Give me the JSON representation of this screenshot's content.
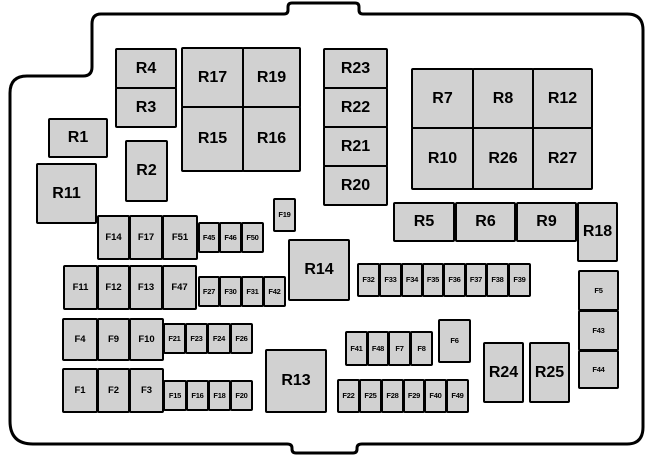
{
  "colors": {
    "background": "#ffffff",
    "box_fill": "#d1d1d1",
    "box_border": "#000000",
    "outline": "#000000"
  },
  "boxes": [
    {
      "label": "R4",
      "kind": "lg",
      "x": 115,
      "y": 48,
      "w": 62,
      "h": 41
    },
    {
      "label": "R3",
      "kind": "lg",
      "x": 115,
      "y": 87,
      "w": 62,
      "h": 41
    },
    {
      "label": "R17",
      "kind": "lg",
      "x": 181,
      "y": 47,
      "w": 63,
      "h": 61
    },
    {
      "label": "R19",
      "kind": "lg",
      "x": 242,
      "y": 47,
      "w": 59,
      "h": 61
    },
    {
      "label": "R15",
      "kind": "lg",
      "x": 181,
      "y": 106,
      "w": 63,
      "h": 66
    },
    {
      "label": "R16",
      "kind": "lg",
      "x": 242,
      "y": 106,
      "w": 59,
      "h": 66
    },
    {
      "label": "R1",
      "kind": "lg",
      "x": 48,
      "y": 118,
      "w": 60,
      "h": 40
    },
    {
      "label": "R2",
      "kind": "lg",
      "x": 125,
      "y": 140,
      "w": 43,
      "h": 62
    },
    {
      "label": "R11",
      "kind": "lg",
      "x": 36,
      "y": 163,
      "w": 61,
      "h": 61
    },
    {
      "label": "R23",
      "kind": "lg",
      "x": 323,
      "y": 48,
      "w": 65,
      "h": 41
    },
    {
      "label": "R22",
      "kind": "lg",
      "x": 323,
      "y": 87,
      "w": 65,
      "h": 41
    },
    {
      "label": "R21",
      "kind": "lg",
      "x": 323,
      "y": 126,
      "w": 65,
      "h": 41
    },
    {
      "label": "R20",
      "kind": "lg",
      "x": 323,
      "y": 165,
      "w": 65,
      "h": 41
    },
    {
      "label": "R7",
      "kind": "lg",
      "x": 411,
      "y": 68,
      "w": 63,
      "h": 61
    },
    {
      "label": "R8",
      "kind": "lg",
      "x": 472,
      "y": 68,
      "w": 62,
      "h": 61
    },
    {
      "label": "R12",
      "kind": "lg",
      "x": 532,
      "y": 68,
      "w": 61,
      "h": 61
    },
    {
      "label": "R10",
      "kind": "lg",
      "x": 411,
      "y": 127,
      "w": 63,
      "h": 63
    },
    {
      "label": "R26",
      "kind": "lg",
      "x": 472,
      "y": 127,
      "w": 62,
      "h": 63
    },
    {
      "label": "R27",
      "kind": "lg",
      "x": 532,
      "y": 127,
      "w": 61,
      "h": 63
    },
    {
      "label": "R5",
      "kind": "lg",
      "x": 393,
      "y": 202,
      "w": 62,
      "h": 40
    },
    {
      "label": "R6",
      "kind": "lg",
      "x": 455,
      "y": 202,
      "w": 61,
      "h": 40
    },
    {
      "label": "R9",
      "kind": "lg",
      "x": 516,
      "y": 202,
      "w": 61,
      "h": 40
    },
    {
      "label": "R18",
      "kind": "lg",
      "x": 577,
      "y": 202,
      "w": 41,
      "h": 60
    },
    {
      "label": "R14",
      "kind": "lg",
      "x": 288,
      "y": 239,
      "w": 62,
      "h": 62
    },
    {
      "label": "R13",
      "kind": "lg",
      "x": 265,
      "y": 349,
      "w": 62,
      "h": 64
    },
    {
      "label": "R24",
      "kind": "lg",
      "x": 483,
      "y": 342,
      "w": 41,
      "h": 61
    },
    {
      "label": "R25",
      "kind": "lg",
      "x": 529,
      "y": 342,
      "w": 41,
      "h": 61
    },
    {
      "label": "F14",
      "kind": "md",
      "x": 97,
      "y": 215,
      "w": 33,
      "h": 45
    },
    {
      "label": "F17",
      "kind": "md",
      "x": 129,
      "y": 215,
      "w": 34,
      "h": 45
    },
    {
      "label": "F51",
      "kind": "md",
      "x": 162,
      "y": 215,
      "w": 36,
      "h": 45
    },
    {
      "label": "F11",
      "kind": "md",
      "x": 63,
      "y": 265,
      "w": 35,
      "h": 45
    },
    {
      "label": "F12",
      "kind": "md",
      "x": 97,
      "y": 265,
      "w": 33,
      "h": 45
    },
    {
      "label": "F13",
      "kind": "md",
      "x": 129,
      "y": 265,
      "w": 34,
      "h": 45
    },
    {
      "label": "F47",
      "kind": "md",
      "x": 162,
      "y": 265,
      "w": 35,
      "h": 45
    },
    {
      "label": "F4",
      "kind": "md",
      "x": 62,
      "y": 318,
      "w": 36,
      "h": 43
    },
    {
      "label": "F9",
      "kind": "md",
      "x": 97,
      "y": 318,
      "w": 33,
      "h": 43
    },
    {
      "label": "F10",
      "kind": "md",
      "x": 129,
      "y": 318,
      "w": 35,
      "h": 43
    },
    {
      "label": "F1",
      "kind": "md",
      "x": 62,
      "y": 368,
      "w": 36,
      "h": 45
    },
    {
      "label": "F2",
      "kind": "md",
      "x": 97,
      "y": 368,
      "w": 33,
      "h": 45
    },
    {
      "label": "F3",
      "kind": "md",
      "x": 129,
      "y": 368,
      "w": 35,
      "h": 45
    },
    {
      "label": "F45",
      "kind": "sm",
      "x": 198,
      "y": 222,
      "w": 22,
      "h": 31
    },
    {
      "label": "F46",
      "kind": "sm",
      "x": 219,
      "y": 222,
      "w": 23,
      "h": 31
    },
    {
      "label": "F50",
      "kind": "sm",
      "x": 241,
      "y": 222,
      "w": 23,
      "h": 31
    },
    {
      "label": "F27",
      "kind": "sm",
      "x": 198,
      "y": 276,
      "w": 22,
      "h": 31
    },
    {
      "label": "F30",
      "kind": "sm",
      "x": 219,
      "y": 276,
      "w": 23,
      "h": 31
    },
    {
      "label": "F31",
      "kind": "sm",
      "x": 241,
      "y": 276,
      "w": 23,
      "h": 31
    },
    {
      "label": "F42",
      "kind": "sm",
      "x": 263,
      "y": 276,
      "w": 23,
      "h": 31
    },
    {
      "label": "F21",
      "kind": "sm",
      "x": 163,
      "y": 323,
      "w": 23,
      "h": 31
    },
    {
      "label": "F23",
      "kind": "sm",
      "x": 185,
      "y": 323,
      "w": 23,
      "h": 31
    },
    {
      "label": "F24",
      "kind": "sm",
      "x": 207,
      "y": 323,
      "w": 24,
      "h": 31
    },
    {
      "label": "F26",
      "kind": "sm",
      "x": 230,
      "y": 323,
      "w": 23,
      "h": 31
    },
    {
      "label": "F15",
      "kind": "sm",
      "x": 163,
      "y": 380,
      "w": 24,
      "h": 31
    },
    {
      "label": "F16",
      "kind": "sm",
      "x": 186,
      "y": 380,
      "w": 23,
      "h": 31
    },
    {
      "label": "F18",
      "kind": "sm",
      "x": 208,
      "y": 380,
      "w": 23,
      "h": 31
    },
    {
      "label": "F20",
      "kind": "sm",
      "x": 230,
      "y": 380,
      "w": 23,
      "h": 31
    },
    {
      "label": "F19",
      "kind": "sm",
      "x": 273,
      "y": 198,
      "w": 23,
      "h": 34
    },
    {
      "label": "F32",
      "kind": "sm",
      "x": 357,
      "y": 263,
      "w": 23,
      "h": 34
    },
    {
      "label": "F33",
      "kind": "sm",
      "x": 379,
      "y": 263,
      "w": 23,
      "h": 34
    },
    {
      "label": "F34",
      "kind": "sm",
      "x": 401,
      "y": 263,
      "w": 22,
      "h": 34
    },
    {
      "label": "F35",
      "kind": "sm",
      "x": 422,
      "y": 263,
      "w": 22,
      "h": 34
    },
    {
      "label": "F36",
      "kind": "sm",
      "x": 443,
      "y": 263,
      "w": 23,
      "h": 34
    },
    {
      "label": "F37",
      "kind": "sm",
      "x": 465,
      "y": 263,
      "w": 22,
      "h": 34
    },
    {
      "label": "F38",
      "kind": "sm",
      "x": 486,
      "y": 263,
      "w": 23,
      "h": 34
    },
    {
      "label": "F39",
      "kind": "sm",
      "x": 508,
      "y": 263,
      "w": 23,
      "h": 34
    },
    {
      "label": "F41",
      "kind": "sm",
      "x": 345,
      "y": 331,
      "w": 23,
      "h": 35
    },
    {
      "label": "F48",
      "kind": "sm",
      "x": 367,
      "y": 331,
      "w": 22,
      "h": 35
    },
    {
      "label": "F7",
      "kind": "sm",
      "x": 388,
      "y": 331,
      "w": 23,
      "h": 35
    },
    {
      "label": "F8",
      "kind": "sm",
      "x": 410,
      "y": 331,
      "w": 23,
      "h": 35
    },
    {
      "label": "F6",
      "kind": "sm",
      "x": 438,
      "y": 319,
      "w": 33,
      "h": 44
    },
    {
      "label": "F22",
      "kind": "sm",
      "x": 337,
      "y": 379,
      "w": 23,
      "h": 34
    },
    {
      "label": "F25",
      "kind": "sm",
      "x": 359,
      "y": 379,
      "w": 23,
      "h": 34
    },
    {
      "label": "F28",
      "kind": "sm",
      "x": 381,
      "y": 379,
      "w": 23,
      "h": 34
    },
    {
      "label": "F29",
      "kind": "sm",
      "x": 403,
      "y": 379,
      "w": 22,
      "h": 34
    },
    {
      "label": "F40",
      "kind": "sm",
      "x": 424,
      "y": 379,
      "w": 23,
      "h": 34
    },
    {
      "label": "F49",
      "kind": "sm",
      "x": 446,
      "y": 379,
      "w": 23,
      "h": 34
    },
    {
      "label": "F5",
      "kind": "sm",
      "x": 578,
      "y": 270,
      "w": 41,
      "h": 41
    },
    {
      "label": "F43",
      "kind": "sm",
      "x": 578,
      "y": 310,
      "w": 41,
      "h": 41
    },
    {
      "label": "F44",
      "kind": "sm",
      "x": 578,
      "y": 350,
      "w": 41,
      "h": 39
    }
  ]
}
